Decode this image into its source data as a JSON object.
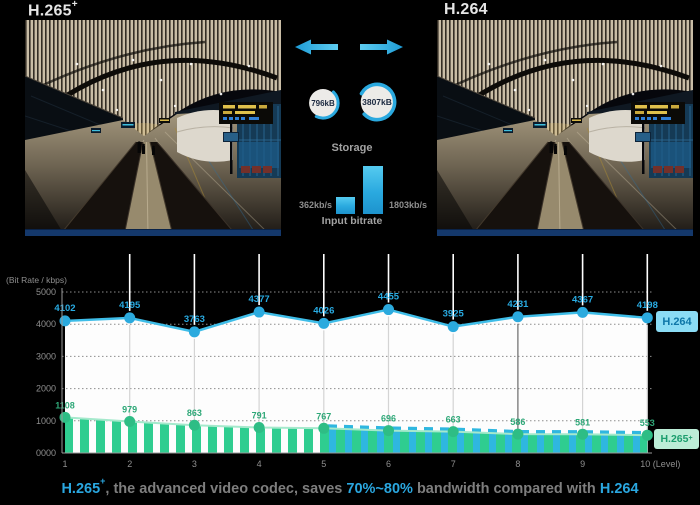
{
  "app": {
    "background": "#000000",
    "accent_blue": "#29ABE2",
    "accent_green": "#2ECC8E"
  },
  "header": {
    "left_title": "H.265",
    "left_title_sup": "+",
    "right_title": "H.264"
  },
  "middle": {
    "storage_label": "Storage",
    "storage_left": "796kB",
    "storage_right": "3807kB",
    "bitrate_left": "362kb/s",
    "bitrate_right": "1803kb/s",
    "bitrate_label": "Input bitrate"
  },
  "chart_data": {
    "type": "line",
    "title": "",
    "ylabel": "(Bit Rate / kbps)",
    "xlabel": "Level",
    "x": [
      1,
      2,
      3,
      4,
      5,
      6,
      7,
      8,
      9,
      10
    ],
    "xticks": [
      "1",
      "2",
      "3",
      "4",
      "5",
      "6",
      "7",
      "8",
      "9",
      "10 (Level)"
    ],
    "yticks": [
      "5000",
      "4000",
      "3000",
      "2000",
      "1000",
      "0000"
    ],
    "ylim": [
      0,
      5000
    ],
    "grid": true,
    "legend_position": "right",
    "series": [
      {
        "name": "H.264",
        "color": "#29ABE2",
        "style": "line-with-white-area",
        "values": [
          4102,
          4195,
          3763,
          4377,
          4026,
          4455,
          3925,
          4231,
          4367,
          4198
        ]
      },
      {
        "name": "H.265+",
        "color": "#2FA878",
        "style": "line-with-hatched-bars",
        "values": [
          1108,
          979,
          863,
          791,
          767,
          696,
          663,
          586,
          581,
          553
        ]
      }
    ],
    "legend": [
      {
        "label": "H.264",
        "sup": "",
        "bg": "#8BDCF5",
        "fg": "#0E76A8"
      },
      {
        "label": "H.265",
        "sup": "+",
        "bg": "#BCEDD7",
        "fg": "#1C9E6E"
      }
    ]
  },
  "caption": {
    "codec": "H.265",
    "codec_sup": "+",
    "text_a": ", the advanced video codec, saves ",
    "savings": "70%~80%",
    "text_b": " bandwidth compared with ",
    "codec2": "H.264"
  }
}
